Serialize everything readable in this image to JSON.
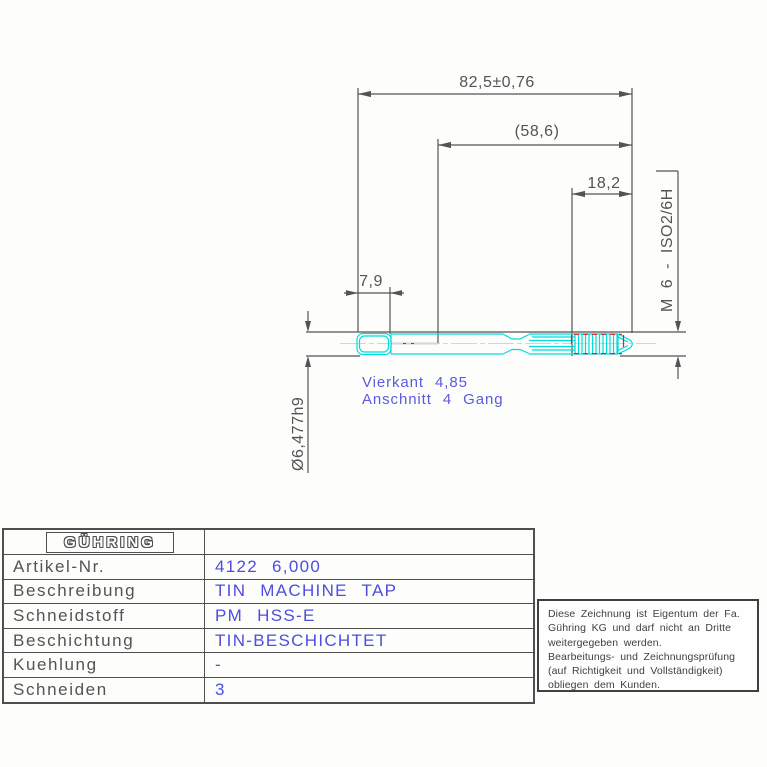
{
  "drawing": {
    "dimensions": {
      "overall_length": "82,5±0,76",
      "reference_length": "(58,6)",
      "thread_length": "18,2",
      "square_length": "7,9",
      "shank_diameter": "Ø6,477h9",
      "thread_spec": "M 6 - ISO2/6H"
    },
    "notes": {
      "line1": "Vierkant 4,85",
      "line2": "Anschnitt 4 Gang"
    },
    "colors": {
      "dimension_lines": "#545454",
      "tool_outline": "#00dcdc",
      "centerline": "#f0f000",
      "thread_highlight": "#cc2a2a",
      "note_text": "#5b5be0",
      "value_text": "#4d4de0"
    }
  },
  "infoTable": {
    "logo": "GÜHRING",
    "rows": [
      {
        "label": "Artikel-Nr.",
        "value": "4122 6,000"
      },
      {
        "label": "Beschreibung",
        "value": "TIN MACHINE TAP"
      },
      {
        "label": "Schneidstoff",
        "value": "PM HSS-E"
      },
      {
        "label": "Beschichtung",
        "value": "TIN-BESCHICHTET"
      },
      {
        "label": "Kuehlung",
        "value": "-"
      },
      {
        "label": "Schneiden",
        "value": "3"
      }
    ]
  },
  "disclaimer": {
    "lines": [
      "Diese Zeichnung ist Eigentum der Fa.",
      "Gühring KG und darf nicht an Dritte",
      "weitergegeben werden.",
      "Bearbeitungs- und Zeichnungsprüfung",
      "(auf Richtigkeit und Vollständigkeit)",
      "obliegen dem Kunden."
    ]
  }
}
